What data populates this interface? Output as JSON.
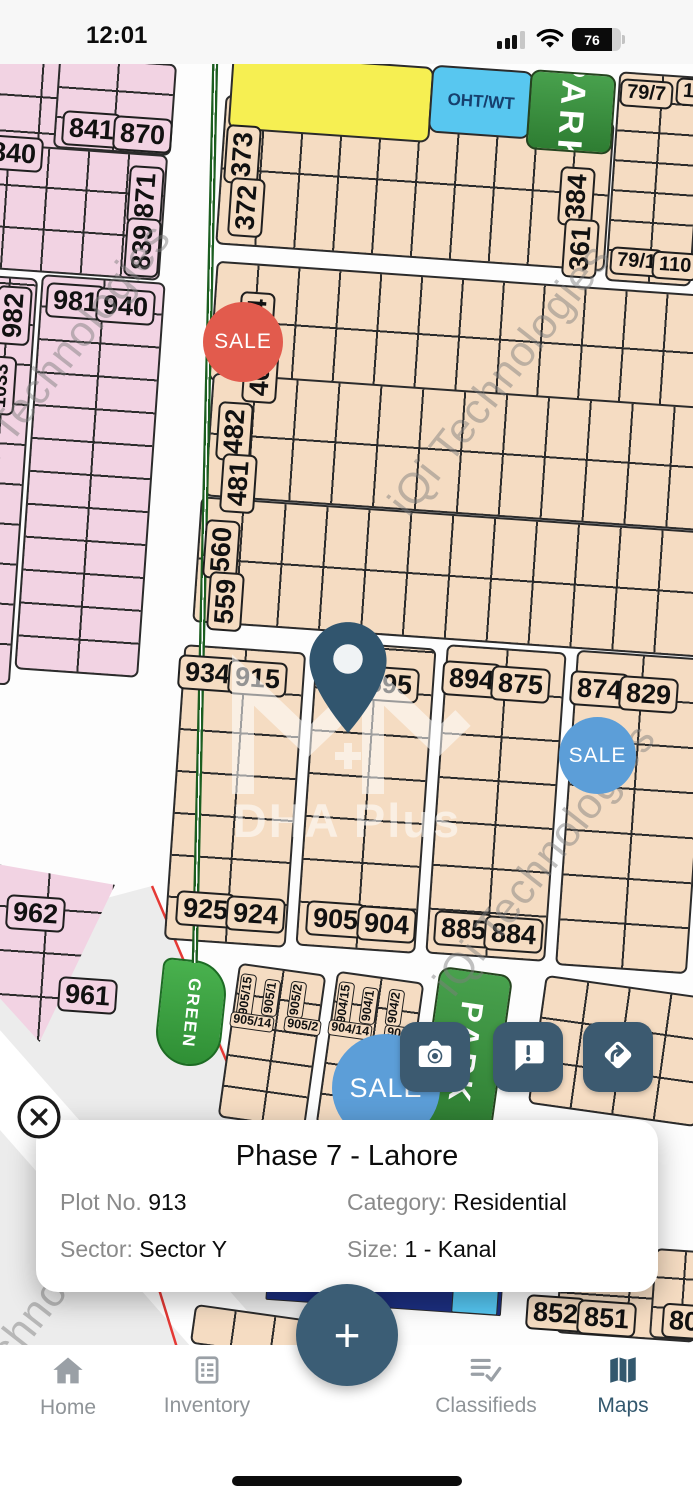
{
  "status_bar": {
    "time": "12:01",
    "battery_percent": "76"
  },
  "map": {
    "sale_label": "SALE",
    "oht_label": "OHT/WT",
    "park_label": "PARK",
    "green_label": "GREEN",
    "watermark_center": "DHA Plus",
    "watermark_text": "iQi Technologies",
    "watermarks": [
      {
        "x": 60,
        "y": 360
      },
      {
        "x": 500,
        "y": 380
      },
      {
        "x": 545,
        "y": 860
      },
      {
        "x": 30,
        "y": 1320
      }
    ],
    "plot_labels": [
      {
        "t": "840",
        "x": -16,
        "y": 136,
        "pink": true
      },
      {
        "t": "841",
        "x": 62,
        "y": 112,
        "pink": true
      },
      {
        "t": "870",
        "x": 113,
        "y": 117,
        "pink": true
      },
      {
        "t": "871",
        "x": 116,
        "y": 178,
        "pink": true,
        "rot": -86
      },
      {
        "t": "839",
        "x": 113,
        "y": 230,
        "pink": true,
        "rot": -86
      },
      {
        "t": "982",
        "x": -16,
        "y": 298,
        "pink": true,
        "rot": -86
      },
      {
        "t": "1033",
        "x": -28,
        "y": 372,
        "pink": true,
        "rot": -86,
        "mid": true
      },
      {
        "t": "981",
        "x": 46,
        "y": 284,
        "pink": true
      },
      {
        "t": "940",
        "x": 96,
        "y": 289,
        "pink": true
      },
      {
        "t": "962",
        "x": 6,
        "y": 896,
        "pink": true
      },
      {
        "t": "961",
        "x": 58,
        "y": 978,
        "pink": true
      },
      {
        "t": "373",
        "x": 213,
        "y": 137,
        "rot": -86
      },
      {
        "t": "372",
        "x": 217,
        "y": 190,
        "rot": -86
      },
      {
        "t": "384",
        "x": 547,
        "y": 179,
        "rot": -86
      },
      {
        "t": "361",
        "x": 551,
        "y": 231,
        "rot": -86
      },
      {
        "t": "79/7",
        "x": 620,
        "y": 80,
        "mid": true
      },
      {
        "t": "1",
        "x": 676,
        "y": 78,
        "mid": true
      },
      {
        "t": "79/1",
        "x": 610,
        "y": 248,
        "mid": true
      },
      {
        "t": "110",
        "x": 652,
        "y": 252,
        "mid": true
      },
      {
        "t": "404",
        "x": 227,
        "y": 304,
        "rot": -86
      },
      {
        "t": "403",
        "x": 231,
        "y": 356,
        "rot": -86
      },
      {
        "t": "482",
        "x": 205,
        "y": 414,
        "rot": -86
      },
      {
        "t": "481",
        "x": 209,
        "y": 466,
        "rot": -86
      },
      {
        "t": "560",
        "x": 192,
        "y": 532,
        "rot": -86
      },
      {
        "t": "559",
        "x": 196,
        "y": 584,
        "rot": -86
      },
      {
        "t": "934",
        "x": 178,
        "y": 656
      },
      {
        "t": "915",
        "x": 228,
        "y": 661
      },
      {
        "t": "895",
        "x": 360,
        "y": 667
      },
      {
        "t": "894",
        "x": 442,
        "y": 662
      },
      {
        "t": "875",
        "x": 491,
        "y": 667
      },
      {
        "t": "874",
        "x": 570,
        "y": 672
      },
      {
        "t": "829",
        "x": 619,
        "y": 677
      },
      {
        "t": "925",
        "x": 176,
        "y": 892
      },
      {
        "t": "924",
        "x": 226,
        "y": 897
      },
      {
        "t": "905",
        "x": 306,
        "y": 902
      },
      {
        "t": "904",
        "x": 357,
        "y": 907
      },
      {
        "t": "885",
        "x": 434,
        "y": 912
      },
      {
        "t": "884",
        "x": 484,
        "y": 917
      },
      {
        "t": "852",
        "x": 526,
        "y": 1296
      },
      {
        "t": "851",
        "x": 577,
        "y": 1301
      },
      {
        "t": "80",
        "x": 662,
        "y": 1304
      },
      {
        "t": "905/15",
        "x": 224,
        "y": 988,
        "small": true,
        "rot": -82
      },
      {
        "t": "905/1",
        "x": 252,
        "y": 990,
        "small": true,
        "rot": -82
      },
      {
        "t": "905/2",
        "x": 278,
        "y": 992,
        "small": true,
        "rot": -82
      },
      {
        "t": "905/14",
        "x": 230,
        "y": 1014,
        "small": true,
        "rot": 8
      },
      {
        "t": "905/2",
        "x": 284,
        "y": 1018,
        "small": true,
        "rot": 8
      },
      {
        "t": "904/15",
        "x": 322,
        "y": 996,
        "small": true,
        "rot": -82
      },
      {
        "t": "904/1",
        "x": 350,
        "y": 998,
        "small": true,
        "rot": -82
      },
      {
        "t": "904/2",
        "x": 376,
        "y": 1000,
        "small": true,
        "rot": -82
      },
      {
        "t": "904/14",
        "x": 328,
        "y": 1022,
        "small": true,
        "rot": 8
      },
      {
        "t": "904",
        "x": 384,
        "y": 1026,
        "small": true,
        "rot": 8
      }
    ]
  },
  "card": {
    "title": "Phase 7 - Lahore",
    "plot_no_label": "Plot No.",
    "plot_no": "913",
    "category_label": "Category:",
    "category": "Residential",
    "sector_label": "Sector:",
    "sector": "Sector Y",
    "size_label": "Size:",
    "size": "1 - Kanal"
  },
  "tab_bar": {
    "items": [
      {
        "label": "Home"
      },
      {
        "label": "Inventory"
      },
      {
        "label": "Classifieds"
      },
      {
        "label": "Maps"
      }
    ],
    "active": "Maps",
    "fab_label": "+"
  }
}
